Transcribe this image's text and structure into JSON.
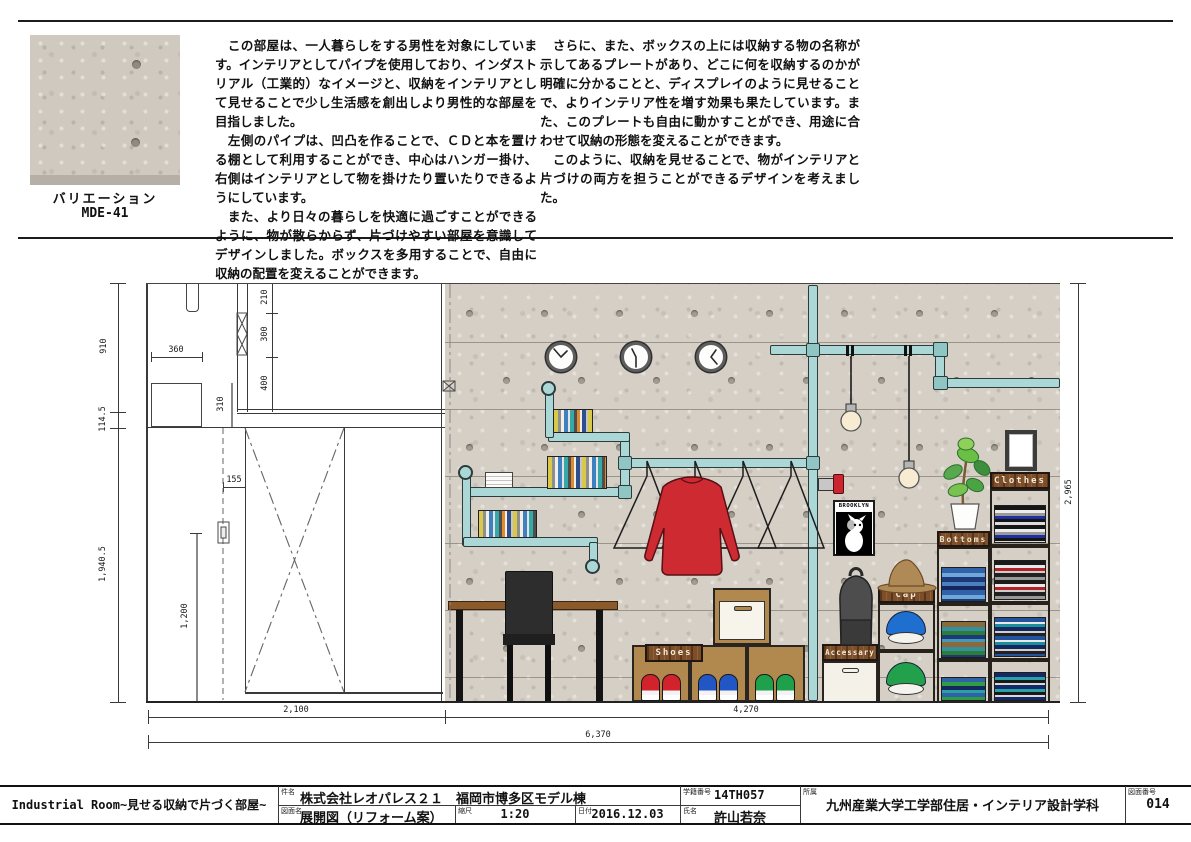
{
  "header": {
    "sample_caption_line1": "バリエーション",
    "sample_caption_line2": "MDE-41",
    "paragraph_left": "　この部屋は、一人暮らしをする男性を対象にしています。インテリアとしてパイプを使用しており、インダストリアル（工業的）なイメージと、収納をインテリアとして見せることで少し生活感を創出しより男性的な部屋を目指しました。\n　左側のパイプは、凹凸を作ることで、ＣＤと本を置ける棚として利用することができ、中心はハンガー掛け、右側はインテリアとして物を掛けたり置いたりできるようにしています。\n　また、より日々の暮らしを快適に過ごすことができるように、物が散らからず、片づけやすい部屋を意識してデザインしました。ボックスを多用することで、自由に収納の配置を変えることができます。",
    "paragraph_right": "　さらに、また、ボックスの上には収納する物の名称が示してあるプレートがあり、どこに何を収納するのかが明確に分かることと、ディスプレイのように見せることで、よりインテリア性を増す効果も果たしています。また、このプレートも自由に動かすことができ、用途に合わせて収納の形態を変えることができます。\n　このように、収納を見せることで、物がインテリアと片づけの両方を担うことができるデザインを考えました。"
  },
  "drawing": {
    "poster_title": "BROOKLYN",
    "plates": {
      "clothes": "Clothes",
      "bottoms": "Bottoms",
      "cap": "Cap",
      "accessary": "Accessary",
      "shoes": "Shoes"
    },
    "dims": {
      "w910": "910",
      "w114_5": "114.5",
      "w1940_5": "1,940.5",
      "w360": "360",
      "w310": "310",
      "w210": "210",
      "w300": "300",
      "w400": "400",
      "w155": "155",
      "w1200": "1,200",
      "w2100": "2,100",
      "w4270": "4,270",
      "w6370": "6,370",
      "h2965": "2,965"
    }
  },
  "titleblock": {
    "project_title": "Industrial Room~見せる収納で片づく部屋~",
    "subject_label": "件名",
    "subject": "株式会社レオパレス２１　福岡市博多区モデル棟",
    "drawing_name_label": "図面名",
    "drawing_name": "展開図（リフォーム案）",
    "scale_label": "縮尺",
    "scale": "1:20",
    "date_label": "日付",
    "date": "2016.12.03",
    "student_id_label": "学籍番号",
    "student_id": "14TH057",
    "name_label": "氏名",
    "name": "許山若奈",
    "affiliation_label": "所属",
    "affiliation": "九州産業大学工学部住居・インテリア設計学科",
    "sheet_no_label": "図面番号",
    "sheet_no": "014"
  }
}
